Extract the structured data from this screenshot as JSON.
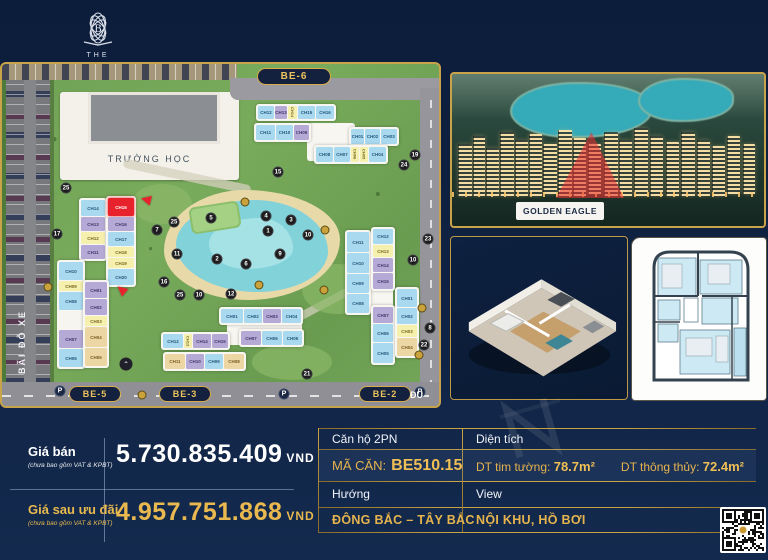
{
  "brand": {
    "line1": "THE",
    "line2": "BEVERLY"
  },
  "icons": {
    "parking_badge": "P",
    "chevron_up": "⌃"
  },
  "site_map": {
    "school_label": "TRƯỜNG HỌC",
    "parking_label": "BÃI ĐỖ XE",
    "street_label": "ĐU",
    "pills": {
      "be6": "BE-6",
      "be5": "BE-5",
      "be3": "BE-3",
      "be2": "BE-2"
    },
    "highlight_unit": "CH15",
    "cell_colors": {
      "blue": "#a9d9ef",
      "purple": "#b5aad6",
      "yellow": "#f6f0ae",
      "tan": "#ecd6a4",
      "red": "#e8222d",
      "blank": "#f7f5f0"
    },
    "clusters": {
      "be6_row1": [
        {
          "t": "CH12",
          "c": "blue"
        },
        {
          "t": "CH13",
          "c": "purple"
        },
        {
          "t": "CH14",
          "c": "yellow"
        },
        {
          "t": "CH15",
          "c": "blue"
        },
        {
          "t": "CH16",
          "c": "blue"
        }
      ],
      "be6_row2": [
        {
          "t": "CH11",
          "c": "blue"
        },
        {
          "t": "CH10",
          "c": "blue"
        },
        {
          "t": "CH09",
          "c": "purple"
        }
      ],
      "be6_row3": [
        {
          "t": "CH01",
          "c": "blue"
        },
        {
          "t": "CH02",
          "c": "blue"
        },
        {
          "t": "CH03",
          "c": "blue"
        }
      ],
      "be6_row4": [
        {
          "t": "CH08",
          "c": "blue"
        },
        {
          "t": "CH07",
          "c": "blue"
        },
        {
          "t": "CH06",
          "c": "yellow"
        },
        {
          "t": "CH05",
          "c": "yellow"
        },
        {
          "t": "CH04",
          "c": "blue"
        }
      ],
      "be5_colA": [
        {
          "t": "CH14",
          "c": "blue"
        },
        {
          "t": "CH13",
          "c": "purple"
        },
        {
          "t": "CH12",
          "c": "yellow"
        },
        {
          "t": "CH11",
          "c": "purple"
        }
      ],
      "be5_colB": [
        {
          "t": "CH15",
          "c": "red"
        },
        {
          "t": "CH16",
          "c": "purple"
        },
        {
          "t": "CH17",
          "c": "blue"
        },
        {
          "t": "CH18",
          "c": "yellow"
        },
        {
          "t": "CH19",
          "c": "yellow"
        },
        {
          "t": "CH20",
          "c": "blue"
        }
      ],
      "be5_colC": [
        {
          "t": "CH10",
          "c": "blue"
        },
        {
          "t": "CH09",
          "c": "yellow"
        },
        {
          "t": "CH08",
          "c": "blue"
        },
        {
          "t": "",
          "c": "blank"
        },
        {
          "t": "CH07",
          "c": "purple"
        },
        {
          "t": "CH06",
          "c": "blue"
        }
      ],
      "be5_colD": [
        {
          "t": "CH01",
          "c": "purple"
        },
        {
          "t": "CH02",
          "c": "purple"
        },
        {
          "t": "CH03",
          "c": "yellow"
        },
        {
          "t": "CH04",
          "c": "tan"
        },
        {
          "t": "CH05",
          "c": "tan"
        }
      ],
      "be3_row1": [
        {
          "t": "CH01",
          "c": "blue"
        },
        {
          "t": "CH02",
          "c": "blue"
        },
        {
          "t": "CH03",
          "c": "purple"
        },
        {
          "t": "CH04",
          "c": "blue"
        }
      ],
      "be3_row2": [
        {
          "t": "CH07",
          "c": "purple"
        },
        {
          "t": "CH06",
          "c": "blue"
        },
        {
          "t": "CH05",
          "c": "blue"
        }
      ],
      "be3_row3": [
        {
          "t": "CH12",
          "c": "blue"
        },
        {
          "t": "CH13",
          "c": "yellow"
        },
        {
          "t": "CH14",
          "c": "purple"
        },
        {
          "t": "CH15",
          "c": "purple"
        }
      ],
      "be3_row4": [
        {
          "t": "CH11",
          "c": "tan"
        },
        {
          "t": "CH10",
          "c": "purple"
        },
        {
          "t": "CH09",
          "c": "blue"
        },
        {
          "t": "CH08",
          "c": "tan"
        }
      ],
      "be2_colL": [
        {
          "t": "CH11",
          "c": "blue"
        },
        {
          "t": "CH10",
          "c": "blue"
        },
        {
          "t": "CH09",
          "c": "blue"
        },
        {
          "t": "CH08",
          "c": "blue"
        }
      ],
      "be2_colM1": [
        {
          "t": "CH12",
          "c": "blue"
        },
        {
          "t": "CH13",
          "c": "yellow"
        },
        {
          "t": "CH14",
          "c": "purple"
        },
        {
          "t": "CH15",
          "c": "purple"
        }
      ],
      "be2_colM2": [
        {
          "t": "CH07",
          "c": "purple"
        },
        {
          "t": "CH06",
          "c": "blue"
        },
        {
          "t": "CH05",
          "c": "blue"
        }
      ],
      "be2_colR": [
        {
          "t": "CH01",
          "c": "blue"
        },
        {
          "t": "CH02",
          "c": "blue"
        },
        {
          "t": "CH03",
          "c": "yellow"
        },
        {
          "t": "CH04",
          "c": "tan"
        }
      ]
    },
    "markers": [
      {
        "n": "25",
        "x": 64,
        "y": 124
      },
      {
        "n": "17",
        "x": 55,
        "y": 170
      },
      {
        "n": "15",
        "x": 276,
        "y": 108
      },
      {
        "n": "19",
        "x": 413,
        "y": 91
      },
      {
        "n": "24",
        "x": 402,
        "y": 101
      },
      {
        "n": "5",
        "x": 209,
        "y": 154
      },
      {
        "n": "4",
        "x": 264,
        "y": 152
      },
      {
        "n": "3",
        "x": 289,
        "y": 156
      },
      {
        "n": "1",
        "x": 266,
        "y": 167
      },
      {
        "n": "10",
        "x": 306,
        "y": 171
      },
      {
        "n": "25",
        "x": 172,
        "y": 158
      },
      {
        "n": "7",
        "x": 155,
        "y": 166
      },
      {
        "n": "11",
        "x": 175,
        "y": 190
      },
      {
        "n": "2",
        "x": 215,
        "y": 195
      },
      {
        "n": "6",
        "x": 244,
        "y": 200
      },
      {
        "n": "9",
        "x": 278,
        "y": 190
      },
      {
        "n": "16",
        "x": 162,
        "y": 218
      },
      {
        "n": "25",
        "x": 178,
        "y": 231
      },
      {
        "n": "10",
        "x": 197,
        "y": 231
      },
      {
        "n": "12",
        "x": 229,
        "y": 230
      },
      {
        "n": "23",
        "x": 426,
        "y": 175
      },
      {
        "n": "10",
        "x": 411,
        "y": 196
      },
      {
        "n": "8",
        "x": 428,
        "y": 264
      },
      {
        "n": "22",
        "x": 422,
        "y": 281
      },
      {
        "n": "21",
        "x": 305,
        "y": 310
      }
    ]
  },
  "photo": {
    "caption": "GOLDEN EAGLE"
  },
  "pricing": {
    "rows": [
      {
        "label": "Giá bán",
        "note": "(chưa bao gồm VAT & KPBT)",
        "value": "5.730.835.409",
        "currency": "VND"
      },
      {
        "label": "Giá sau ưu đãi",
        "note": "(chưa bao gồm VAT & KPBT)",
        "value": "4.957.751.868",
        "currency": "VND"
      }
    ]
  },
  "spec_table": {
    "unit_type": "Căn hộ 2PN",
    "area_header": "Diện tích",
    "code_label": "MÃ CĂN:",
    "code_value": "BE510.15",
    "area1_label": "DT tim tường:",
    "area1_value": "78.7m²",
    "area2_label": "DT thông thủy:",
    "area2_value": "72.4m²",
    "direction_label": "Hướng",
    "view_label": "View",
    "direction_value": "ĐÔNG BẮC – TÂY BẮC",
    "view_value": "NỘI KHU, HỒ BƠI"
  },
  "colors": {
    "accent_gold": "#c9a34a",
    "navy_bg": "#0e2141",
    "highlight_red": "#e8222d"
  }
}
